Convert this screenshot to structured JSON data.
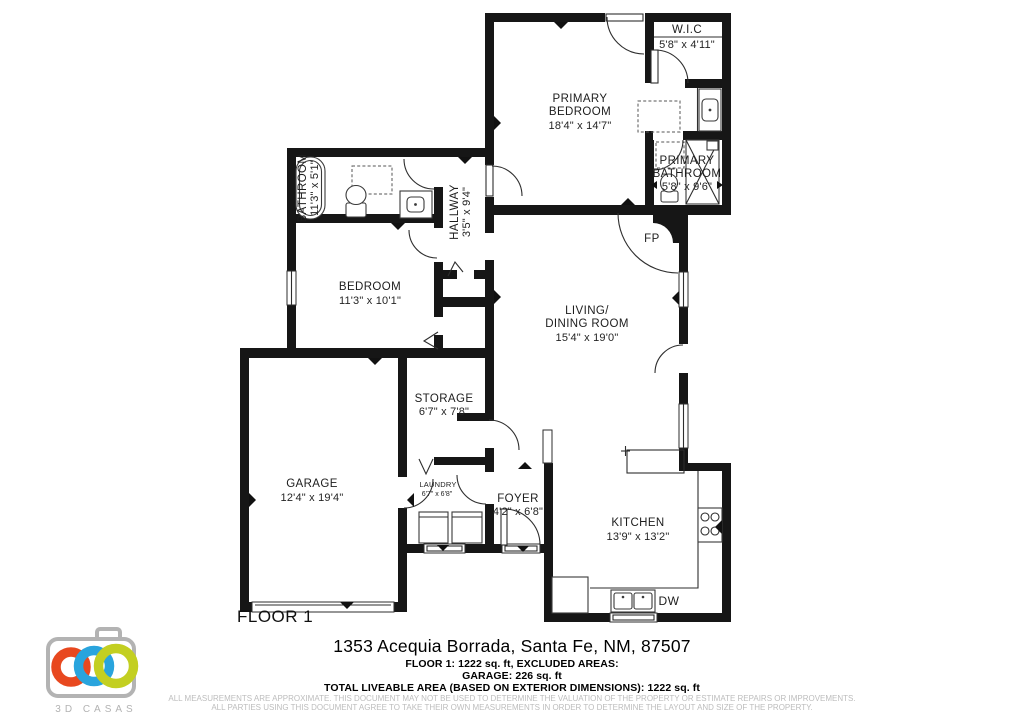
{
  "page": {
    "background": "#ffffff"
  },
  "plan": {
    "floor_label": "FLOOR 1",
    "fireplace_label": "FP",
    "dishwasher_label": "DW",
    "wall_color": "#161616",
    "rooms": {
      "wic": {
        "name": "W.I.C",
        "dims": "5'8\" x 4'11\""
      },
      "primary_bedroom": {
        "name_line1": "PRIMARY",
        "name_line2": "BEDROOM",
        "dims": "18'4\" x 14'7\""
      },
      "primary_bathroom": {
        "name_line1": "PRIMARY",
        "name_line2": "BATHROOM",
        "dims": "5'8\" x 9'6\""
      },
      "bathroom": {
        "name": "BATHROOM",
        "dims": "11'3\" x 5'1\""
      },
      "hallway": {
        "name": "HALLWAY",
        "dims": "3'5\" x 9'4\""
      },
      "bedroom": {
        "name": "BEDROOM",
        "dims": "11'3\" x 10'1\""
      },
      "living_dining": {
        "name_line1": "LIVING/",
        "name_line2": "DINING ROOM",
        "dims": "15'4\" x 19'0\""
      },
      "storage": {
        "name": "STORAGE",
        "dims": "6'7\" x 7'8\""
      },
      "garage": {
        "name": "GARAGE",
        "dims": "12'4\" x 19'4\""
      },
      "laundry": {
        "name": "LAUNDRY",
        "dims": "6'7\" x 6'8\""
      },
      "foyer": {
        "name": "FOYER",
        "dims": "4'2\" x 6'8\""
      },
      "kitchen": {
        "name": "KITCHEN",
        "dims": "13'9\" x 13'2\""
      }
    }
  },
  "footer": {
    "address": "1353 Acequia Borrada, Santa Fe, NM, 87507",
    "area_line1": "FLOOR 1: 1222 sq. ft, EXCLUDED AREAS:",
    "area_line2": "GARAGE: 226 sq. ft",
    "area_line3": "TOTAL LIVEABLE AREA (BASED ON EXTERIOR DIMENSIONS): 1222 sq. ft",
    "disclaimer_line1": "ALL MEASUREMENTS ARE APPROXIMATE. THIS DOCUMENT MAY NOT BE USED TO DETERMINE THE VALUATION OF THE PROPERTY OR ESTIMATE REPAIRS OR IMPROVEMENTS.",
    "disclaimer_line2": "ALL PARTIES USING THIS DOCUMENT AGREE TO TAKE THEIR OWN MEASUREMENTS IN ORDER TO DETERMINE THE LAYOUT AND SIZE OF THE PROPERTY."
  },
  "logo": {
    "brand": "3D CASAS",
    "camera_color": "#b3b3b3",
    "ring_colors": {
      "orange": "#e8481f",
      "blue": "#29a4dd",
      "green": "#c3cf21"
    }
  }
}
